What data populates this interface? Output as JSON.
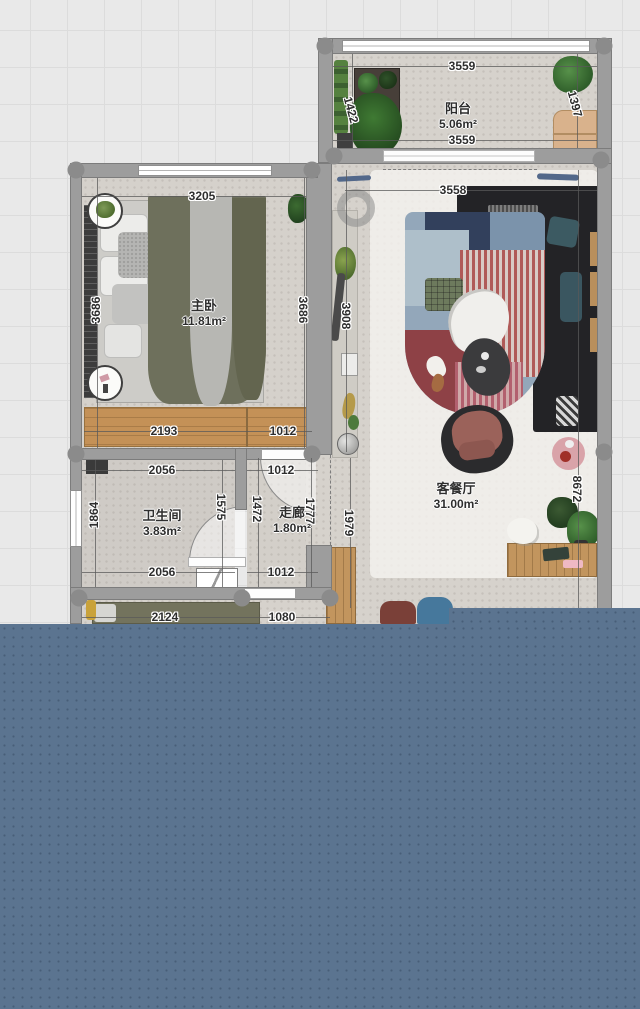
{
  "canvas": {
    "background_color": "#e9e9e9",
    "grid_line_color": "#dcdcdc",
    "grid_size_px": 37
  },
  "panel": {
    "color": "#5b7490",
    "dot_color": "#4e6783"
  },
  "palette": {
    "wall": "#9d9d9d",
    "floor": "#d6d2cc",
    "wardrobe_wood": "#c49157",
    "sofa_dark": "#232326",
    "bed_blanket_olive": "#6e705c",
    "accent_pink_table": "#d9a3a9",
    "accent_teal_pillow": "#3c5a62"
  },
  "floorplan": {
    "rooms": [
      {
        "id": "balcony",
        "name": "阳台",
        "area": "5.06m²",
        "cx": 458,
        "cy": 101
      },
      {
        "id": "master-bedroom",
        "name": "主卧",
        "area": "11.81m²",
        "cx": 204,
        "cy": 298
      },
      {
        "id": "bathroom",
        "name": "卫生间",
        "area": "3.83m²",
        "cx": 162,
        "cy": 508
      },
      {
        "id": "corridor",
        "name": "走廊",
        "area": "1.80m²",
        "cx": 292,
        "cy": 505
      },
      {
        "id": "living-dining",
        "name": "客餐厅",
        "area": "31.00m²",
        "cx": 456,
        "cy": 481
      }
    ],
    "dimensions": [
      {
        "t": "3559",
        "x": 462,
        "y": 66,
        "r": 0
      },
      {
        "t": "1422",
        "x": 351,
        "y": 110,
        "r": 75
      },
      {
        "t": "1397",
        "x": 575,
        "y": 104,
        "r": 75
      },
      {
        "t": "3559",
        "x": 462,
        "y": 140,
        "r": 0
      },
      {
        "t": "3205",
        "x": 202,
        "y": 196,
        "r": 0
      },
      {
        "t": "3558",
        "x": 453,
        "y": 190,
        "r": 0
      },
      {
        "t": "3686",
        "x": 96,
        "y": 310,
        "r": -90
      },
      {
        "t": "3686",
        "x": 303,
        "y": 310,
        "r": 90
      },
      {
        "t": "3908",
        "x": 346,
        "y": 316,
        "r": 90
      },
      {
        "t": "2193",
        "x": 164,
        "y": 431,
        "r": 0
      },
      {
        "t": "1012",
        "x": 283,
        "y": 431,
        "r": 0
      },
      {
        "t": "2056",
        "x": 162,
        "y": 470,
        "r": 0
      },
      {
        "t": "1012",
        "x": 281,
        "y": 470,
        "r": 0
      },
      {
        "t": "1864",
        "x": 94,
        "y": 515,
        "r": -90
      },
      {
        "t": "1575",
        "x": 221,
        "y": 507,
        "r": 90
      },
      {
        "t": "1472",
        "x": 257,
        "y": 509,
        "r": 90
      },
      {
        "t": "1777",
        "x": 310,
        "y": 511,
        "r": 90
      },
      {
        "t": "1979",
        "x": 349,
        "y": 523,
        "r": 90
      },
      {
        "t": "8672",
        "x": 577,
        "y": 489,
        "r": 90
      },
      {
        "t": "2056",
        "x": 162,
        "y": 572,
        "r": 0
      },
      {
        "t": "1012",
        "x": 281,
        "y": 572,
        "r": 0
      },
      {
        "t": "2124",
        "x": 165,
        "y": 617,
        "r": 0
      },
      {
        "t": "1080",
        "x": 282,
        "y": 617,
        "r": 0
      }
    ]
  }
}
